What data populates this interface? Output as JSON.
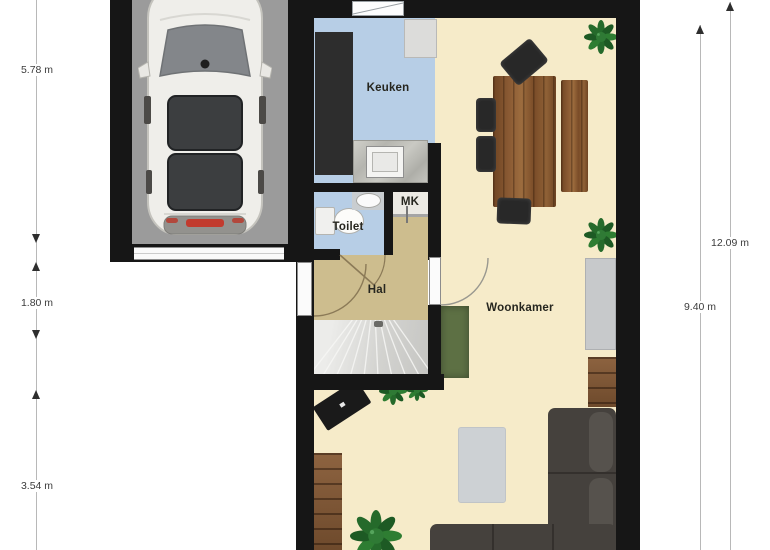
{
  "floorplan": {
    "rooms": {
      "kitchen": "Keuken",
      "toilet": "Toilet",
      "meter_closet": "MK",
      "hall": "Hal",
      "living_room": "Woonkamer"
    },
    "dimensions": {
      "left": [
        "5.78 m",
        "1.80 m",
        "3.54 m"
      ],
      "right": [
        "12.09 m",
        "9.40 m"
      ]
    },
    "furniture_icons": [
      "car-top-view",
      "kitchen-tall-cabinet",
      "kitchen-counter",
      "kitchen-sink",
      "fridge",
      "toilet-bowl",
      "hand-basin",
      "stairs",
      "front-door",
      "dining-table",
      "dining-chair",
      "dining-bench",
      "plant",
      "tv-sideboard",
      "bookshelf",
      "green-rug",
      "gray-rug",
      "corner-sofa",
      "gray-cabinet",
      "wood-cabinet"
    ],
    "colors": {
      "wall": "#161616",
      "garage_floor": "#9b9b9b",
      "kitchen_floor": "#b7cee6",
      "hall_floor": "#cdbd8e",
      "mk_floor": "#eceae4",
      "living_floor": "#f6ebc9",
      "stairs": "#d6d6d3",
      "sofa": "#45413d",
      "rug_green": "#5d7044",
      "rug_gray": "#cdd1d4",
      "wood": "#8a5a33",
      "plant": "#2e7d32",
      "dimension_text": "#3c3c3c"
    }
  }
}
